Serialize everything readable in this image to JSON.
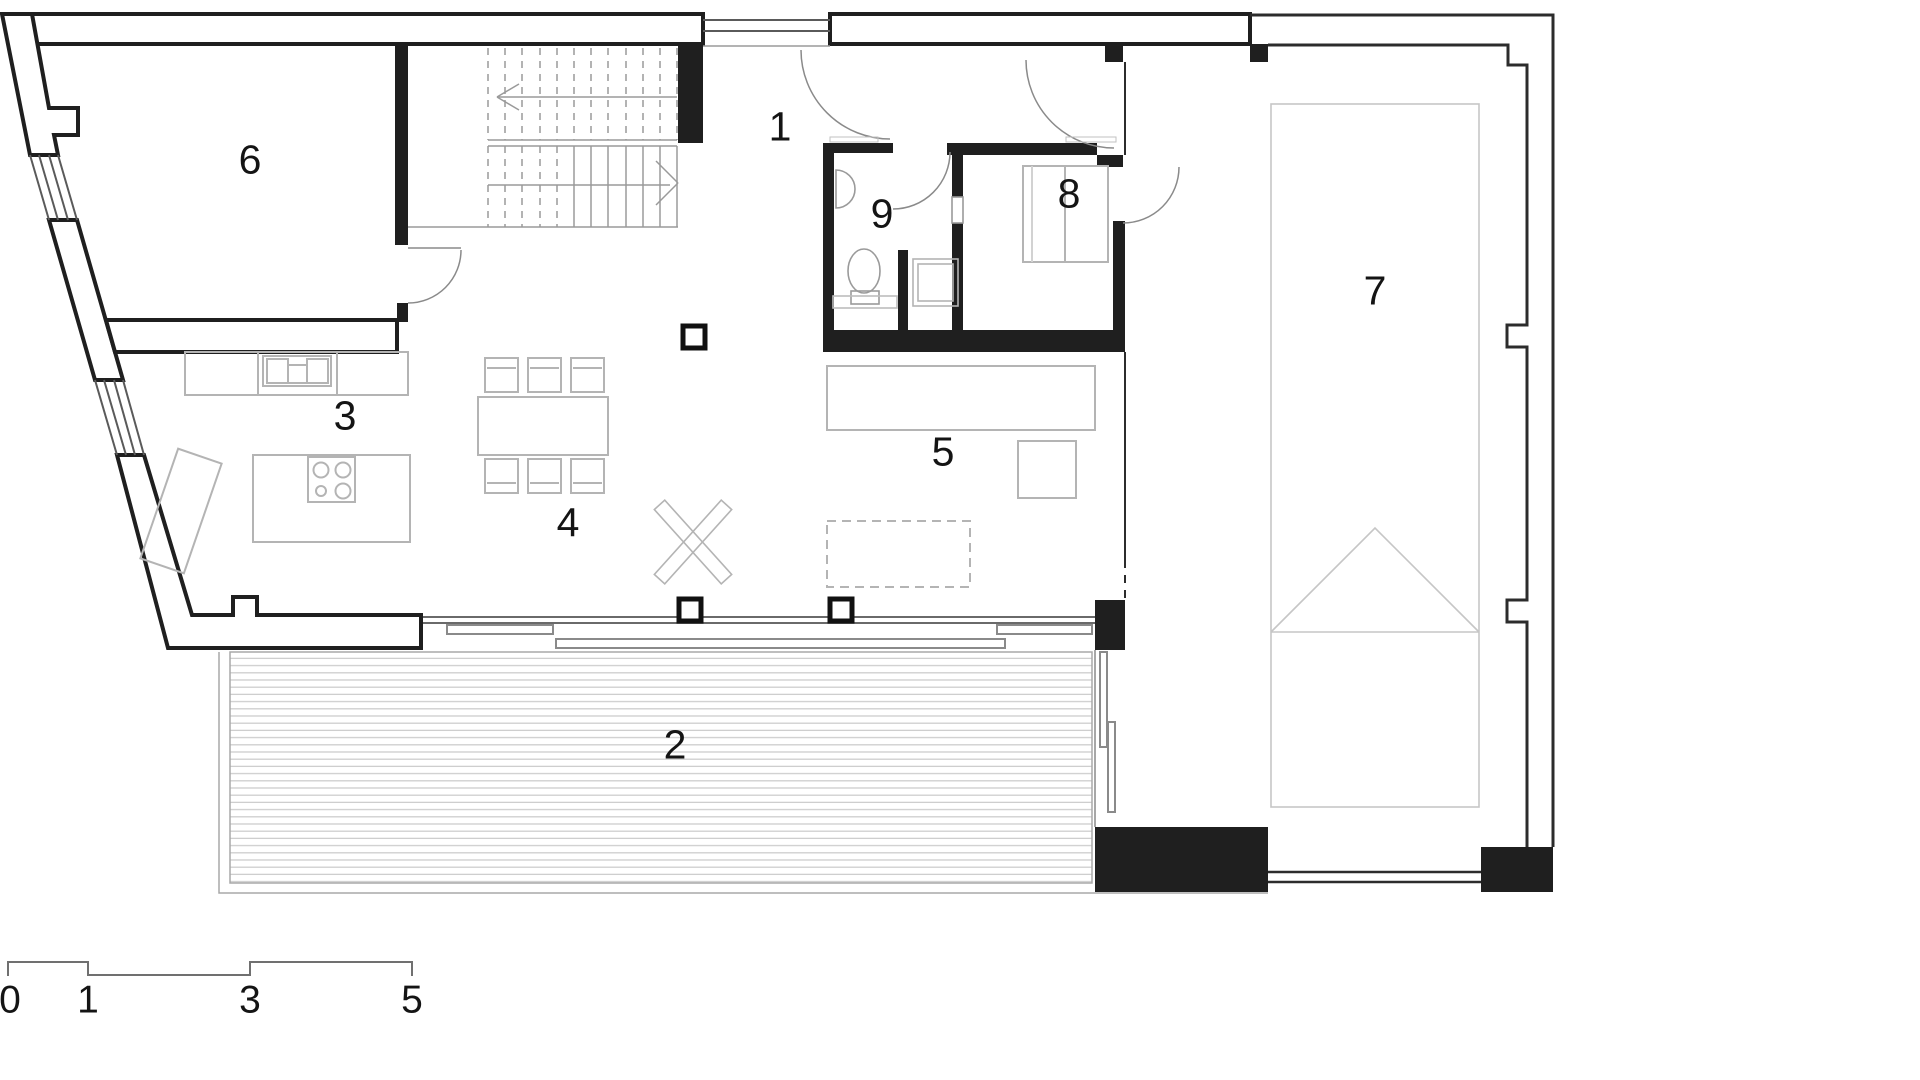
{
  "document": {
    "type": "architectural-floor-plan",
    "floor": "ground-floor"
  },
  "rooms": {
    "r1": "1",
    "r2": "2",
    "r3": "3",
    "r4": "4",
    "r5": "5",
    "r6": "6",
    "r7": "7",
    "r8": "8",
    "r9": "9"
  },
  "scale_bar": {
    "labels": {
      "s0": "0",
      "s1": "1",
      "s3": "3",
      "s5": "5"
    }
  },
  "icons": [
    "stairs-icon",
    "door-swing-icon",
    "toilet-icon",
    "sink-icon",
    "shower-icon",
    "bed-icon",
    "cooktop-icon",
    "dining-table-icon",
    "chair-icon",
    "sofa-icon",
    "coffee-table-icon",
    "kitchen-island-icon",
    "car-space-icon",
    "column-icon",
    "deck-boards-icon",
    "sliding-door-icon",
    "x-marker-icon"
  ],
  "colors": {
    "background": "#ffffff",
    "wall": "#1f1f1f",
    "furniture": "#b4b4b4",
    "window": "#5a5a5a",
    "deck_line": "#cdcdcd",
    "label": "#141414"
  }
}
